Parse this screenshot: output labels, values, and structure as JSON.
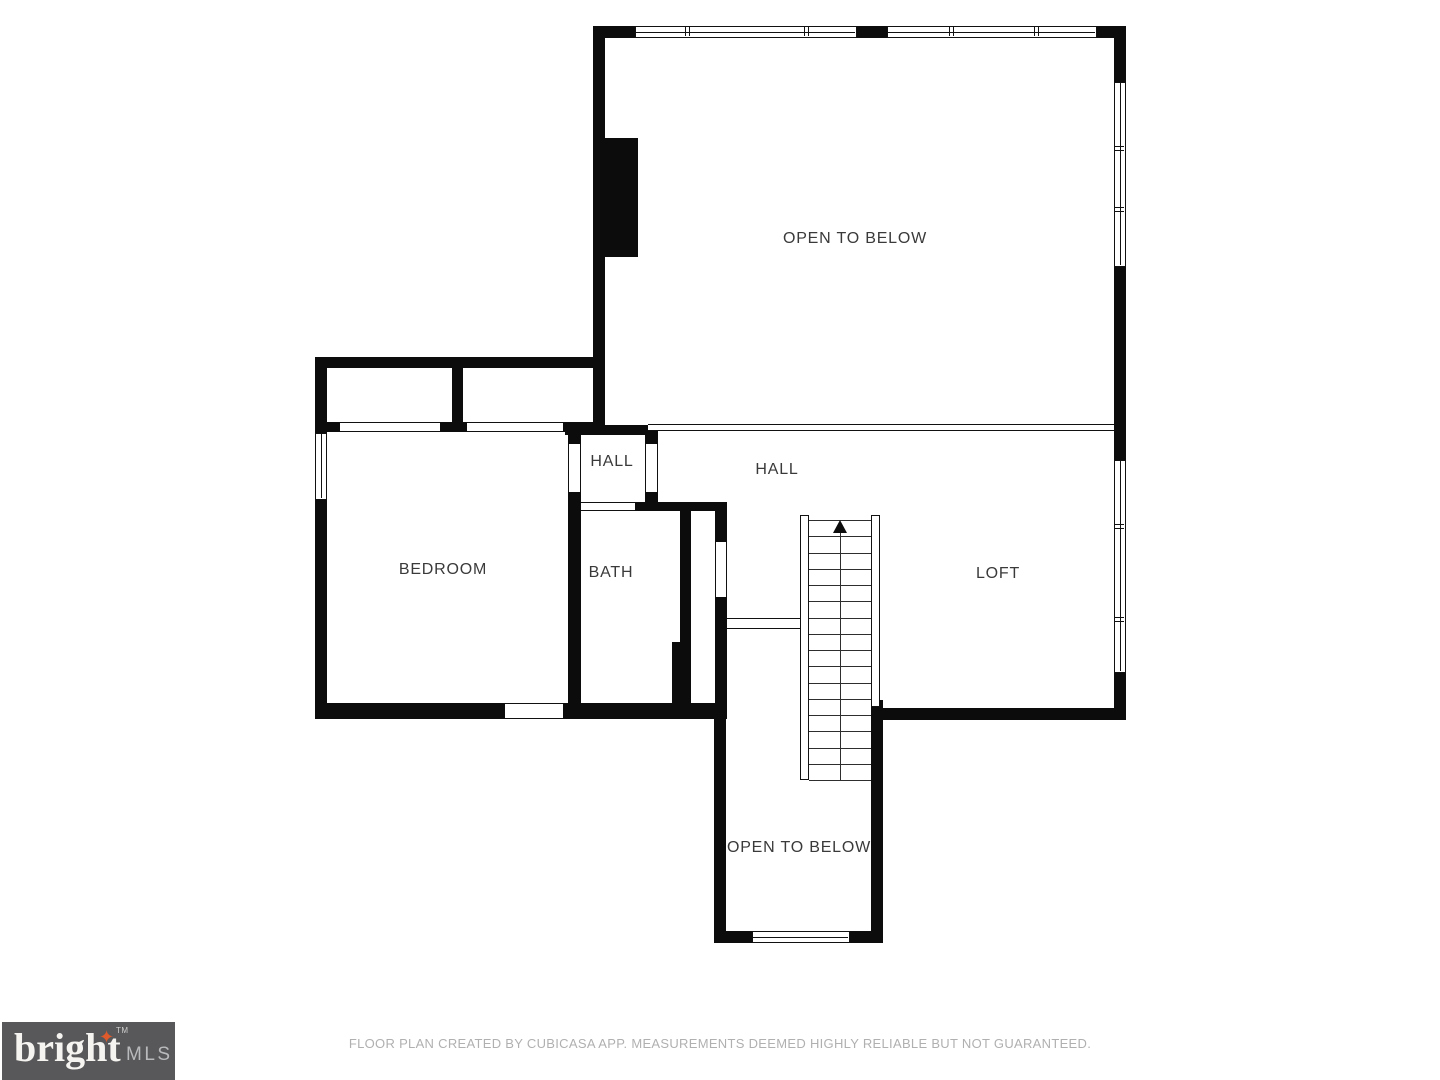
{
  "rooms": {
    "open_to_below_top": {
      "label": "OPEN TO BELOW"
    },
    "hall_small": {
      "label": "HALL"
    },
    "hall_main": {
      "label": "HALL"
    },
    "bedroom": {
      "label": "BEDROOM"
    },
    "bath": {
      "label": "BATH"
    },
    "loft": {
      "label": "LOFT"
    },
    "open_to_below_bottom": {
      "label": "OPEN TO BELOW"
    }
  },
  "footer": {
    "disclaimer": "FLOOR PLAN CREATED BY CUBICASA APP. MEASUREMENTS DEEMED HIGHLY RELIABLE BUT NOT GUARANTEED."
  },
  "logo": {
    "brand": "bright",
    "suffix": "MLS",
    "trademark": "TM",
    "star_glyph": "✦"
  },
  "icons": {
    "stair_direction": "up-arrow"
  },
  "colors": {
    "wall": "#0c0c0c",
    "line": "#111111",
    "label_text": "#3a3a3a",
    "footer_text": "#b0b0b0",
    "logo_box": "#58585a",
    "logo_star": "#e05a2b"
  }
}
